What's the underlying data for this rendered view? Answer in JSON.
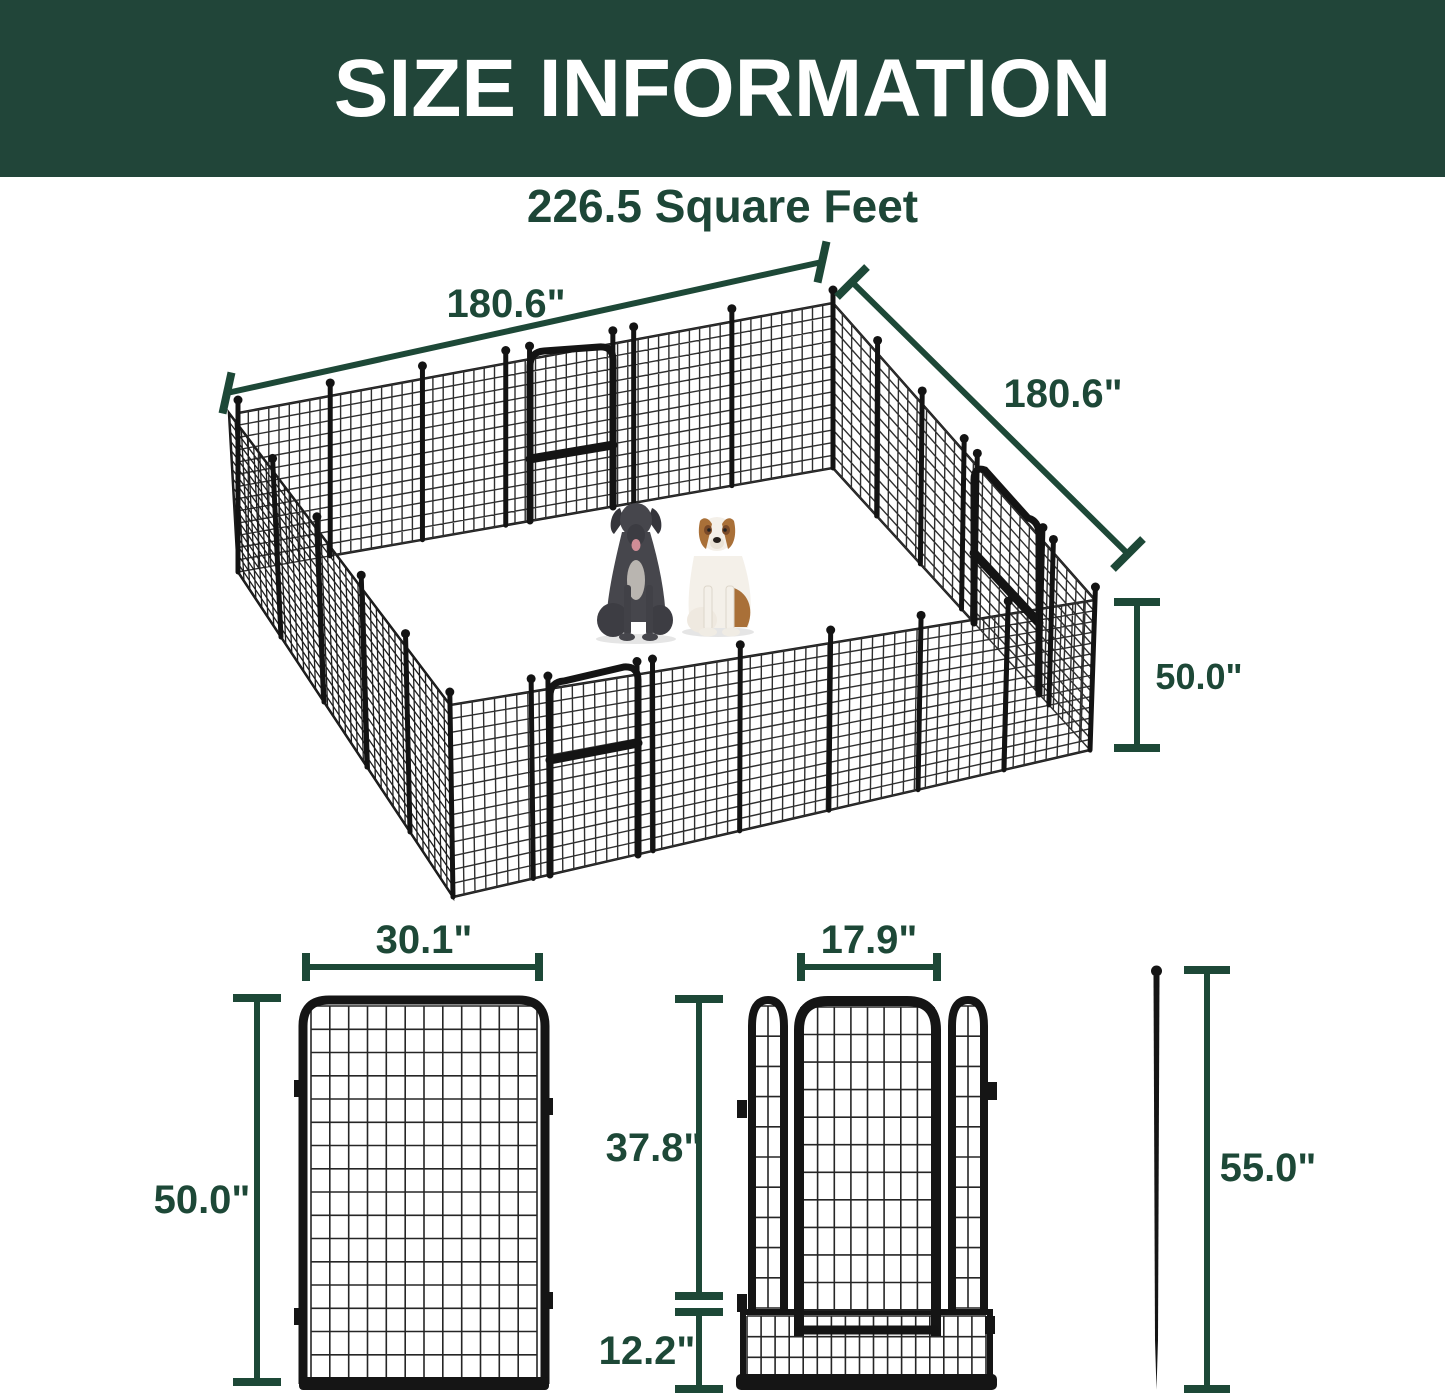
{
  "header": {
    "title": "SIZE INFORMATION"
  },
  "subtitle": "226.5 Square Feet",
  "colors": {
    "header_bg": "#214539",
    "accent_green": "#1d4837",
    "fence_black": "#151515",
    "dane_gray": "#46464c",
    "bernard_brown": "#a97038"
  },
  "pen_overview": {
    "side_back_left": "180.6\"",
    "side_back_right": "180.6\"",
    "panel_height": "50.0\""
  },
  "panel_front_view": {
    "width": "30.1\"",
    "height": "50.0\""
  },
  "door_front_view": {
    "door_width": "17.9\"",
    "door_height": "37.8\"",
    "bottom_mesh_height": "12.2\""
  },
  "ground_stake": {
    "length": "55.0\""
  }
}
